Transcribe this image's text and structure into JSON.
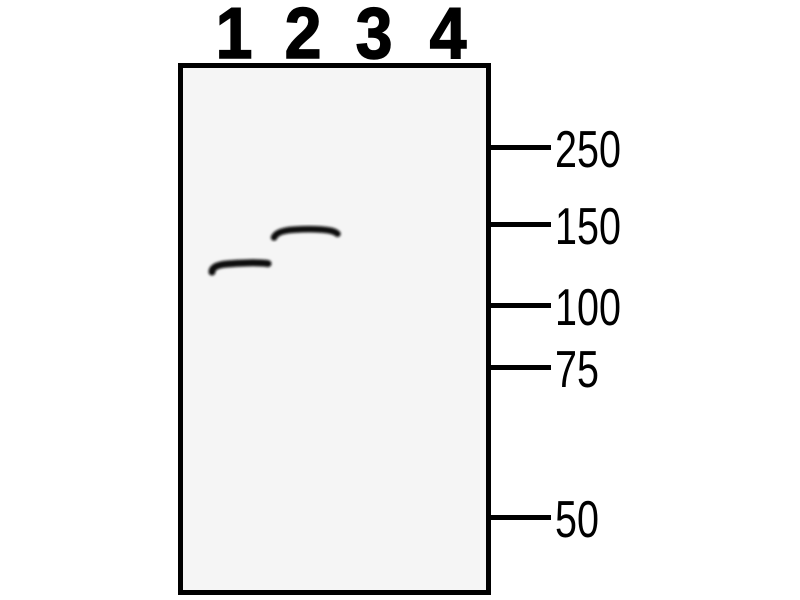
{
  "figure": {
    "type": "western blot",
    "lane_labels": [
      {
        "label": "1"
      },
      {
        "label": "2"
      },
      {
        "label": "3"
      },
      {
        "label": "4"
      }
    ],
    "mw_markers": [
      {
        "label": "250"
      },
      {
        "label": "150"
      },
      {
        "label": "100"
      },
      {
        "label": "75"
      },
      {
        "label": "50"
      }
    ],
    "bands": [
      {
        "lane": "1",
        "path": "M 212 272 C 212 267 218 264.8 227 264 C 240 262.8 258 262.2 268 263.6"
      },
      {
        "lane": "2",
        "path": "M 274 237.5 C 276 232.5 284 230.3 293 229.7 C 306 228.9 321 229 330 230.6 C 333.5 231.4 336 232.3 337.5 233.8"
      }
    ],
    "colors": {
      "background": "#ffffff",
      "membrane_fill": "#f5f5f5",
      "ink": "#000000",
      "band": "#0d0d0d"
    }
  },
  "chart_data": {
    "type": "table",
    "title": "Western blot",
    "lanes": [
      "1",
      "2",
      "3",
      "4"
    ],
    "mw_ladder_kda": [
      250,
      150,
      100,
      75,
      50
    ],
    "bands": [
      {
        "lane": 1,
        "approx_kda": 115
      },
      {
        "lane": 2,
        "approx_kda": 135
      }
    ],
    "legend_position": "right-ladder",
    "grid": false
  }
}
